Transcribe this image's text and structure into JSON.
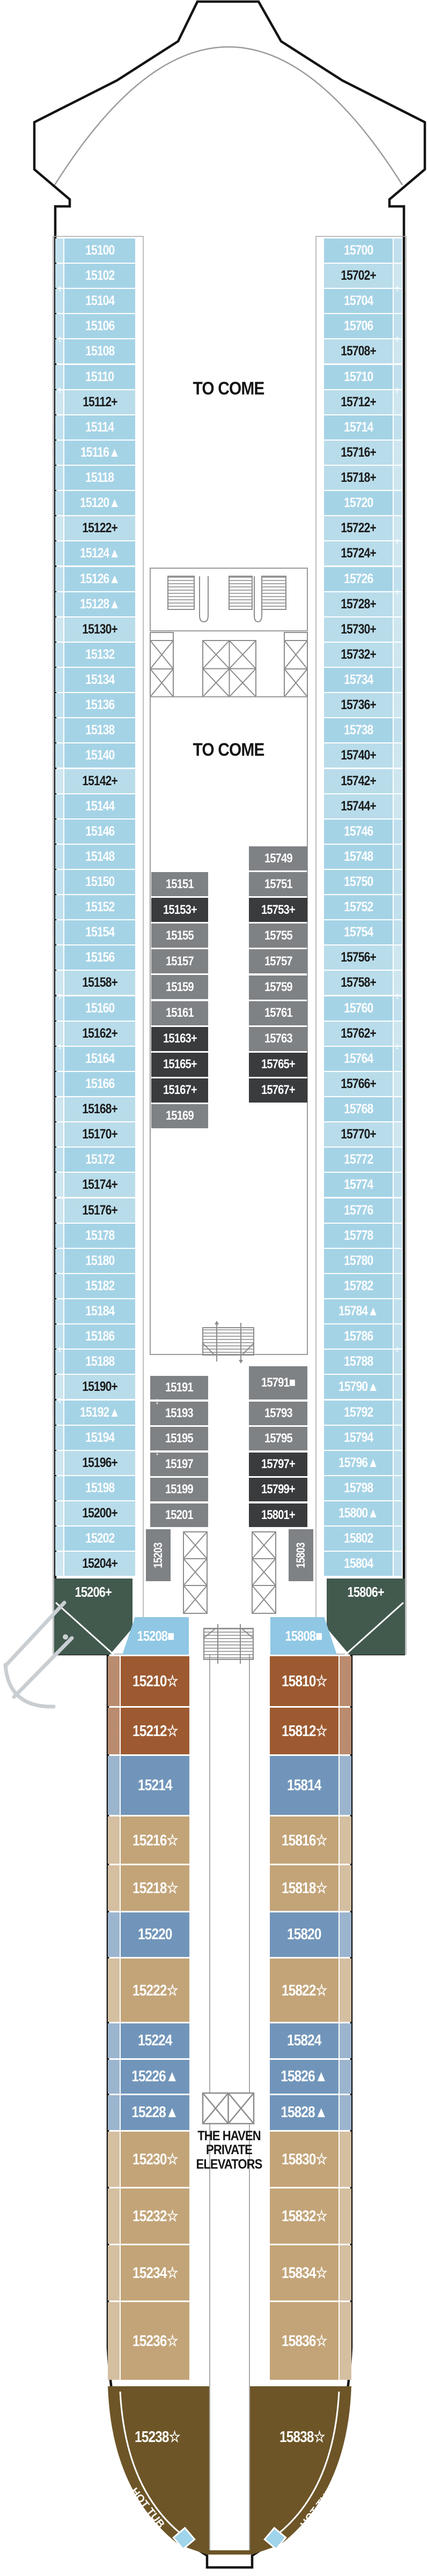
{
  "labels": {
    "to_come_fwd": "TO COME",
    "to_come_mid": "TO COME",
    "haven_line1": "THE HAVEN",
    "haven_line2": "PRIVATE",
    "haven_line3": "ELEVATORS",
    "hot_tub_port": "HOT TUB",
    "hot_tub_starboard": "HOT TUB"
  },
  "colors": {
    "b": "#a5d3e6",
    "bp": "#b9dcea",
    "g": "#7f8285",
    "gd": "#3a3b3d",
    "gr": "#42594e",
    "lb2": "#8fc7e4",
    "br": "#9d5a31",
    "sb": "#7195ba",
    "tn": "#c3a478",
    "db": "#6d5527",
    "hull": "#141414",
    "wall": "#9b9b9b",
    "hot_tub_fill": "#9fd4ea"
  },
  "text_colors": {
    "bp": "#1b1b1b",
    "default": "#ffffff"
  },
  "columns": {
    "left_outer": [
      {
        "t": "15100",
        "c": "b"
      },
      {
        "t": "15102",
        "c": "b"
      },
      {
        "t": "15104",
        "c": "b"
      },
      {
        "t": "15106",
        "c": "b"
      },
      {
        "t": "15108",
        "c": "b"
      },
      {
        "t": "15110",
        "c": "b"
      },
      {
        "t": "15112+",
        "c": "bp"
      },
      {
        "t": "15114",
        "c": "b"
      },
      {
        "t": "15116▲",
        "c": "b"
      },
      {
        "t": "15118",
        "c": "b"
      },
      {
        "t": "15120▲",
        "c": "b"
      },
      {
        "t": "15122+",
        "c": "bp"
      },
      {
        "t": "15124▲",
        "c": "b"
      },
      {
        "t": "15126▲",
        "c": "b"
      },
      {
        "t": "15128▲",
        "c": "b"
      },
      {
        "t": "15130+",
        "c": "bp"
      },
      {
        "t": "15132",
        "c": "b"
      },
      {
        "t": "15134",
        "c": "b"
      },
      {
        "t": "15136",
        "c": "b"
      },
      {
        "t": "15138",
        "c": "b"
      },
      {
        "t": "15140",
        "c": "b"
      },
      {
        "t": "15142+",
        "c": "bp"
      },
      {
        "t": "15144",
        "c": "b"
      },
      {
        "t": "15146",
        "c": "b"
      },
      {
        "t": "15148",
        "c": "b"
      },
      {
        "t": "15150",
        "c": "b"
      },
      {
        "t": "15152",
        "c": "b"
      },
      {
        "t": "15154",
        "c": "b"
      },
      {
        "t": "15156",
        "c": "b"
      },
      {
        "t": "15158+",
        "c": "bp"
      },
      {
        "t": "15160",
        "c": "b"
      },
      {
        "t": "15162+",
        "c": "bp"
      },
      {
        "t": "15164",
        "c": "b"
      },
      {
        "t": "15166",
        "c": "b"
      },
      {
        "t": "15168+",
        "c": "bp"
      },
      {
        "t": "15170+",
        "c": "bp"
      },
      {
        "t": "15172",
        "c": "b"
      },
      {
        "t": "15174+",
        "c": "bp"
      },
      {
        "t": "15176+",
        "c": "bp"
      },
      {
        "t": "15178",
        "c": "b"
      },
      {
        "t": "15180",
        "c": "b"
      },
      {
        "t": "15182",
        "c": "b"
      },
      {
        "t": "15184",
        "c": "b"
      },
      {
        "t": "15186",
        "c": "b"
      },
      {
        "t": "15188",
        "c": "b"
      },
      {
        "t": "15190+",
        "c": "bp"
      },
      {
        "t": "15192▲",
        "c": "b"
      },
      {
        "t": "15194",
        "c": "b"
      },
      {
        "t": "15196+",
        "c": "bp"
      },
      {
        "t": "15198",
        "c": "b"
      },
      {
        "t": "15200+",
        "c": "bp"
      },
      {
        "t": "15202",
        "c": "b"
      },
      {
        "t": "15204+",
        "c": "bp"
      }
    ],
    "right_outer": [
      {
        "t": "15700",
        "c": "b"
      },
      {
        "t": "15702+",
        "c": "bp"
      },
      {
        "t": "15704",
        "c": "b"
      },
      {
        "t": "15706",
        "c": "b"
      },
      {
        "t": "15708+",
        "c": "bp"
      },
      {
        "t": "15710",
        "c": "b"
      },
      {
        "t": "15712+",
        "c": "bp"
      },
      {
        "t": "15714",
        "c": "b"
      },
      {
        "t": "15716+",
        "c": "bp"
      },
      {
        "t": "15718+",
        "c": "bp"
      },
      {
        "t": "15720",
        "c": "b"
      },
      {
        "t": "15722+",
        "c": "bp"
      },
      {
        "t": "15724+",
        "c": "bp"
      },
      {
        "t": "15726",
        "c": "b"
      },
      {
        "t": "15728+",
        "c": "bp"
      },
      {
        "t": "15730+",
        "c": "bp"
      },
      {
        "t": "15732+",
        "c": "bp"
      },
      {
        "t": "15734",
        "c": "b"
      },
      {
        "t": "15736+",
        "c": "bp"
      },
      {
        "t": "15738",
        "c": "b"
      },
      {
        "t": "15740+",
        "c": "bp"
      },
      {
        "t": "15742+",
        "c": "bp"
      },
      {
        "t": "15744+",
        "c": "bp"
      },
      {
        "t": "15746",
        "c": "b"
      },
      {
        "t": "15748",
        "c": "b"
      },
      {
        "t": "15750",
        "c": "b"
      },
      {
        "t": "15752",
        "c": "b"
      },
      {
        "t": "15754",
        "c": "b"
      },
      {
        "t": "15756+",
        "c": "bp"
      },
      {
        "t": "15758+",
        "c": "bp"
      },
      {
        "t": "15760",
        "c": "b"
      },
      {
        "t": "15762+",
        "c": "bp"
      },
      {
        "t": "15764",
        "c": "b"
      },
      {
        "t": "15766+",
        "c": "bp"
      },
      {
        "t": "15768",
        "c": "b"
      },
      {
        "t": "15770+",
        "c": "bp"
      },
      {
        "t": "15772",
        "c": "b"
      },
      {
        "t": "15774",
        "c": "b"
      },
      {
        "t": "15776",
        "c": "b"
      },
      {
        "t": "15778",
        "c": "b"
      },
      {
        "t": "15780",
        "c": "b"
      },
      {
        "t": "15782",
        "c": "b"
      },
      {
        "t": "15784▲",
        "c": "b"
      },
      {
        "t": "15786",
        "c": "b"
      },
      {
        "t": "15788",
        "c": "b"
      },
      {
        "t": "15790▲",
        "c": "b"
      },
      {
        "t": "15792",
        "c": "b"
      },
      {
        "t": "15794",
        "c": "b"
      },
      {
        "t": "15796▲",
        "c": "b"
      },
      {
        "t": "15798",
        "c": "b"
      },
      {
        "t": "15800▲",
        "c": "b"
      },
      {
        "t": "15802",
        "c": "b"
      },
      {
        "t": "15804",
        "c": "b"
      }
    ],
    "int_up_left": [
      {
        "t": "15151",
        "c": "g"
      },
      {
        "t": "15153+",
        "c": "gd"
      },
      {
        "t": "15155",
        "c": "g"
      },
      {
        "t": "15157",
        "c": "g"
      },
      {
        "t": "15159",
        "c": "g"
      },
      {
        "t": "15161",
        "c": "g"
      },
      {
        "t": "15163+",
        "c": "gd"
      },
      {
        "t": "15165+",
        "c": "gd"
      },
      {
        "t": "15167+",
        "c": "gd"
      },
      {
        "t": "15169",
        "c": "g"
      }
    ],
    "int_up_right": [
      {
        "t": "15749",
        "c": "g"
      },
      {
        "t": "15751",
        "c": "g"
      },
      {
        "t": "15753+",
        "c": "gd"
      },
      {
        "t": "15755",
        "c": "g"
      },
      {
        "t": "15757",
        "c": "g"
      },
      {
        "t": "15759",
        "c": "g"
      },
      {
        "t": "15761",
        "c": "g"
      },
      {
        "t": "15763",
        "c": "g"
      },
      {
        "t": "15765+",
        "c": "gd"
      },
      {
        "t": "15767+",
        "c": "gd"
      }
    ],
    "int_lo_left": [
      {
        "t": "15191",
        "c": "g"
      },
      {
        "t": "15193",
        "c": "g"
      },
      {
        "t": "15195",
        "c": "g"
      },
      {
        "t": "15197",
        "c": "g"
      },
      {
        "t": "15199",
        "c": "g"
      },
      {
        "t": "15201",
        "c": "g"
      }
    ],
    "int_lo_right": [
      {
        "t": "15791■",
        "c": "g",
        "h": 62
      },
      {
        "t": "15793",
        "c": "g"
      },
      {
        "t": "15795",
        "c": "g"
      },
      {
        "t": "15797+",
        "c": "gd"
      },
      {
        "t": "15799+",
        "c": "gd"
      },
      {
        "t": "15801+",
        "c": "gd"
      }
    ],
    "stern_left": [
      {
        "t": "15210☆",
        "c": "br"
      },
      {
        "t": "15212☆",
        "c": "br"
      },
      {
        "t": "15214",
        "c": "sb"
      },
      {
        "t": "15216☆",
        "c": "tn"
      },
      {
        "t": "15218☆",
        "c": "tn"
      },
      {
        "t": "15220",
        "c": "sb"
      },
      {
        "t": "15222☆",
        "c": "tn"
      },
      {
        "t": "15224",
        "c": "sb"
      },
      {
        "t": "15226▲",
        "c": "sb"
      },
      {
        "t": "15228▲",
        "c": "sb"
      },
      {
        "t": "15230☆",
        "c": "tn"
      },
      {
        "t": "15232☆",
        "c": "tn"
      },
      {
        "t": "15234☆",
        "c": "tn"
      },
      {
        "t": "15236☆",
        "c": "tn"
      }
    ],
    "stern_right": [
      {
        "t": "15810☆",
        "c": "br"
      },
      {
        "t": "15812☆",
        "c": "br"
      },
      {
        "t": "15814",
        "c": "sb"
      },
      {
        "t": "15816☆",
        "c": "tn"
      },
      {
        "t": "15818☆",
        "c": "tn"
      },
      {
        "t": "15820",
        "c": "sb"
      },
      {
        "t": "15822☆",
        "c": "tn"
      },
      {
        "t": "15824",
        "c": "sb"
      },
      {
        "t": "15826▲",
        "c": "sb"
      },
      {
        "t": "15828▲",
        "c": "sb"
      },
      {
        "t": "15830☆",
        "c": "tn"
      },
      {
        "t": "15832☆",
        "c": "tn"
      },
      {
        "t": "15834☆",
        "c": "tn"
      },
      {
        "t": "15836☆",
        "c": "tn"
      }
    ]
  },
  "specials": [
    {
      "id": "s15206",
      "t": "15206+",
      "c": "gr"
    },
    {
      "id": "s15806",
      "t": "15806+",
      "c": "gr"
    },
    {
      "id": "s15208",
      "t": "15208■",
      "c": "lb2"
    },
    {
      "id": "s15808",
      "t": "15808■",
      "c": "lb2"
    },
    {
      "id": "s15203",
      "t": "15203",
      "c": "g"
    },
    {
      "id": "s15803",
      "t": "15803",
      "c": "g"
    },
    {
      "id": "s15238",
      "t": "15238☆",
      "c": "none"
    },
    {
      "id": "s15838",
      "t": "15838☆",
      "c": "none"
    }
  ],
  "connecting_arrows": [
    {
      "col": "left_outer",
      "after": 1
    },
    {
      "col": "left_outer",
      "after": 3
    },
    {
      "col": "left_outer",
      "after": 5
    },
    {
      "col": "left_outer",
      "after": 29
    },
    {
      "col": "left_outer",
      "after": 31
    },
    {
      "col": "left_outer",
      "after": 43
    },
    {
      "col": "left_outer",
      "after": 45
    },
    {
      "col": "right_outer",
      "after": 1
    },
    {
      "col": "right_outer",
      "after": 3
    },
    {
      "col": "right_outer",
      "after": 5
    },
    {
      "col": "right_outer",
      "after": 11
    },
    {
      "col": "right_outer",
      "after": 13
    },
    {
      "col": "right_outer",
      "after": 29
    },
    {
      "col": "right_outer",
      "after": 31
    },
    {
      "col": "right_outer",
      "after": 43
    },
    {
      "col": "int_lo_left",
      "after": 0
    },
    {
      "col": "int_lo_left",
      "after": 2
    }
  ]
}
